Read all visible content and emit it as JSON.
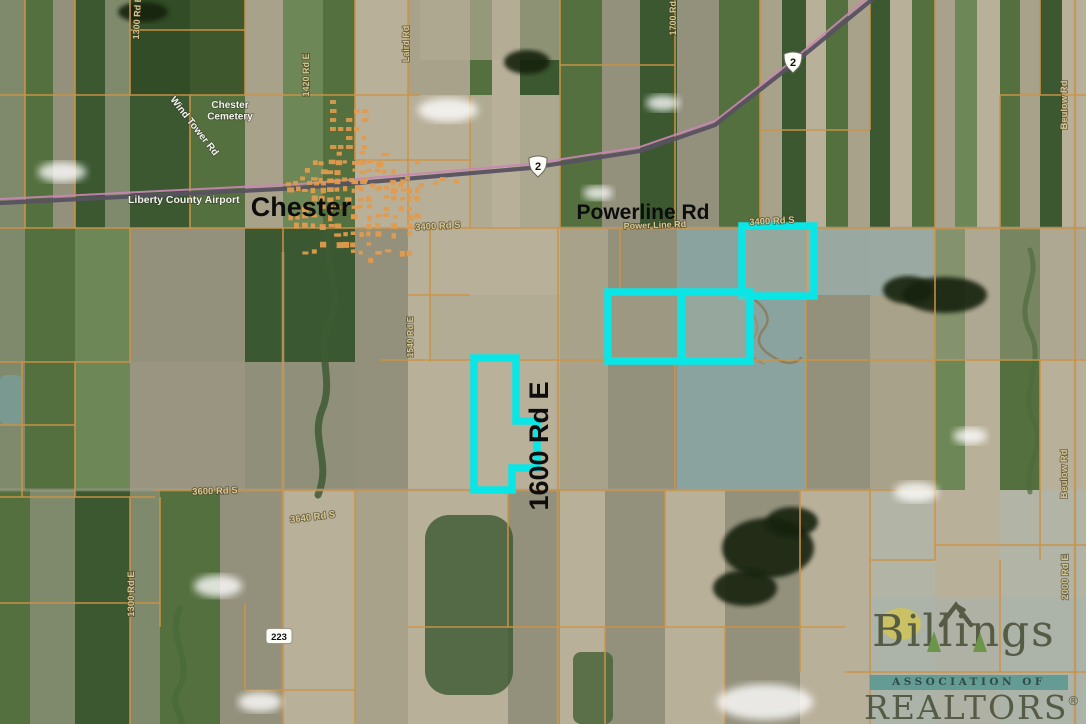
{
  "map": {
    "description": "Aerial parcel map near Chester, MT with listing parcels highlighted in cyan",
    "highlight_color": "#0ae6e6",
    "parcel_line_color": "#cd9345",
    "labels": [
      {
        "id": "chester-cemetery",
        "lines": [
          "Chester",
          "Cemetery"
        ],
        "x": 230,
        "y": 108,
        "rot": 0,
        "size": 10,
        "cls": "lbl-white"
      },
      {
        "id": "wind-tower-rd",
        "text": "Wind Tower Rd",
        "x": 192,
        "y": 128,
        "rot": 52,
        "size": 10,
        "cls": "lbl-white"
      },
      {
        "id": "liberty-county-airport",
        "text": "Liberty County Airport",
        "x": 128,
        "y": 203,
        "rot": 0,
        "size": 10.5,
        "cls": "lbl-white",
        "anchor": "start"
      },
      {
        "id": "chester-town",
        "text": "Chester",
        "x": 301,
        "y": 216,
        "rot": 0,
        "size": 27,
        "cls": "lbl-big"
      },
      {
        "id": "powerline-rd-title",
        "text": "Powerline Rd",
        "x": 643,
        "y": 219,
        "rot": 0,
        "size": 21,
        "cls": "lbl-big"
      },
      {
        "id": "power-line-rd",
        "text": "Power Line Rd",
        "x": 655,
        "y": 228,
        "rot": -2,
        "size": 9,
        "cls": "lbl-road"
      },
      {
        "id": "rd-3400-west",
        "text": "3400 Rd S",
        "x": 438,
        "y": 229,
        "rot": -3,
        "size": 9.5,
        "cls": "lbl-road"
      },
      {
        "id": "rd-3400-east",
        "text": "3400 Rd S",
        "x": 772,
        "y": 224,
        "rot": -3,
        "size": 9.5,
        "cls": "lbl-road"
      },
      {
        "id": "rd-1420",
        "text": "1420 Rd E",
        "x": 309,
        "y": 75,
        "rot": -90,
        "size": 9,
        "cls": "lbl-road"
      },
      {
        "id": "laird-rd",
        "text": "Laird Rd",
        "x": 409,
        "y": 44,
        "rot": -90,
        "size": 9,
        "cls": "lbl-road"
      },
      {
        "id": "rd-1300-north",
        "text": "1300 Rd E",
        "x": 140,
        "y": 18,
        "rot": -87,
        "size": 9,
        "cls": "lbl-road"
      },
      {
        "id": "rd-1700",
        "text": "1700 Rd E",
        "x": 676,
        "y": 14,
        "rot": -90,
        "size": 9,
        "cls": "lbl-road"
      },
      {
        "id": "beulow-rd-north",
        "text": "Beulow Rd",
        "x": 1067,
        "y": 105,
        "rot": -90,
        "size": 9.5,
        "cls": "lbl-road"
      },
      {
        "id": "beulow-rd-south",
        "text": "Beulow Rd",
        "x": 1067,
        "y": 474,
        "rot": -90,
        "size": 9.5,
        "cls": "lbl-road"
      },
      {
        "id": "rd-2000",
        "text": "2000 Rd E",
        "x": 1068,
        "y": 577,
        "rot": -90,
        "size": 9.5,
        "cls": "lbl-road"
      },
      {
        "id": "rd-1540",
        "text": "1540 Rd E",
        "x": 413,
        "y": 337,
        "rot": -90,
        "size": 8.5,
        "cls": "lbl-road"
      },
      {
        "id": "rd-1600-title",
        "text": "1600 Rd E",
        "x": 548,
        "y": 446,
        "rot": -90,
        "size": 27,
        "cls": "lbl-big"
      },
      {
        "id": "rd-3600",
        "text": "3600 Rd S",
        "x": 215,
        "y": 494,
        "rot": -2,
        "size": 9.5,
        "cls": "lbl-road"
      },
      {
        "id": "rd-3640",
        "text": "3640 Rd S",
        "x": 313,
        "y": 520,
        "rot": -7,
        "size": 9.5,
        "cls": "lbl-road"
      },
      {
        "id": "rd-1300-south",
        "text": "1300 Rd E",
        "x": 134,
        "y": 594,
        "rot": -90,
        "size": 9.5,
        "cls": "lbl-road"
      }
    ],
    "route_shields": [
      {
        "id": "us-2-west",
        "type": "us-shield",
        "number": "2",
        "x": 538,
        "y": 166
      },
      {
        "id": "us-2-east",
        "type": "us-shield",
        "number": "2",
        "x": 793,
        "y": 62
      },
      {
        "id": "mt-223",
        "type": "rect-badge",
        "number": "223",
        "x": 279,
        "y": 636
      }
    ],
    "highlighted_parcels": {
      "color": "#0ae6e6",
      "stroke_width": 7.5,
      "shapes": [
        {
          "id": "parcel-north",
          "type": "rect",
          "x": 742,
          "y": 226,
          "w": 72,
          "h": 70
        },
        {
          "id": "parcel-middle-west",
          "type": "rect",
          "x": 608,
          "y": 292,
          "w": 74,
          "h": 69
        },
        {
          "id": "parcel-middle-east",
          "type": "rect",
          "x": 682,
          "y": 292,
          "w": 68,
          "h": 69
        },
        {
          "id": "parcel-west-irregular",
          "type": "polygon",
          "points": [
            [
              474,
              358
            ],
            [
              516,
              358
            ],
            [
              516,
              421
            ],
            [
              537,
              421
            ],
            [
              537,
              468
            ],
            [
              512,
              468
            ],
            [
              512,
              490
            ],
            [
              474,
              490
            ]
          ]
        }
      ]
    }
  },
  "watermark": {
    "org": "Billings Association of REALTORS",
    "line1": "Billings",
    "line2": "ASSOCIATION OF",
    "line3": "REALTORS",
    "registered": "®"
  }
}
